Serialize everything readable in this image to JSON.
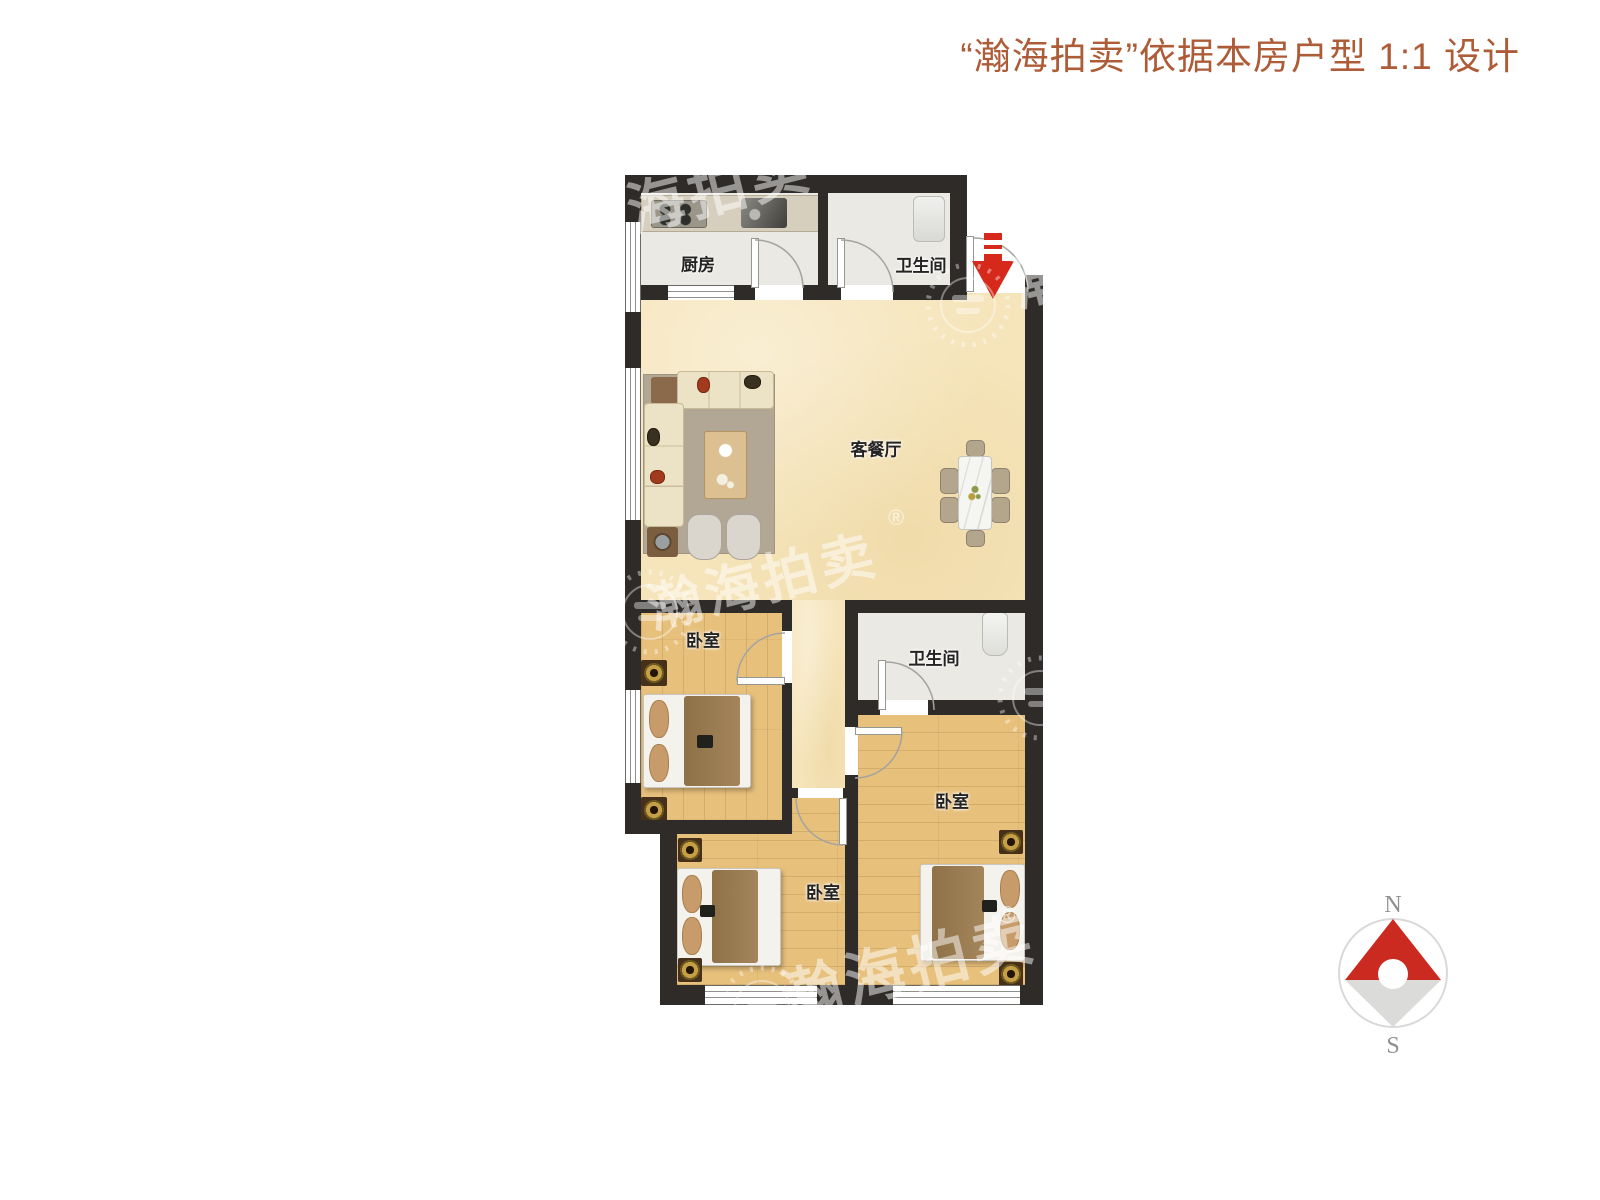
{
  "title": {
    "text": "“瀚海拍卖”依据本房户型 1:1 设计"
  },
  "floor_plan": {
    "rooms": [
      {
        "id": "kitchen",
        "label": "厨房"
      },
      {
        "id": "bathroom-top",
        "label": "卫生间"
      },
      {
        "id": "living-dining",
        "label": "客餐厅"
      },
      {
        "id": "bedroom-left",
        "label": "卧室"
      },
      {
        "id": "bathroom-middle",
        "label": "卫生间"
      },
      {
        "id": "bedroom-right",
        "label": "卧室"
      },
      {
        "id": "bedroom-bottom",
        "label": "卧室"
      }
    ]
  },
  "compass": {
    "north": "N",
    "south": "S"
  },
  "watermark": {
    "brand": "瀚海拍卖",
    "registered": "®"
  },
  "colors": {
    "title_text": "#ae5c38",
    "wall": "#2e2b28",
    "floor_living": "#f6e5bb",
    "floor_wood": "#e7c07c",
    "floor_tile": "#ebe9e3",
    "entry_arrow": "#d6291c",
    "compass_north_needle": "#cb2a20",
    "compass_south_needle": "#dbdbd9"
  }
}
